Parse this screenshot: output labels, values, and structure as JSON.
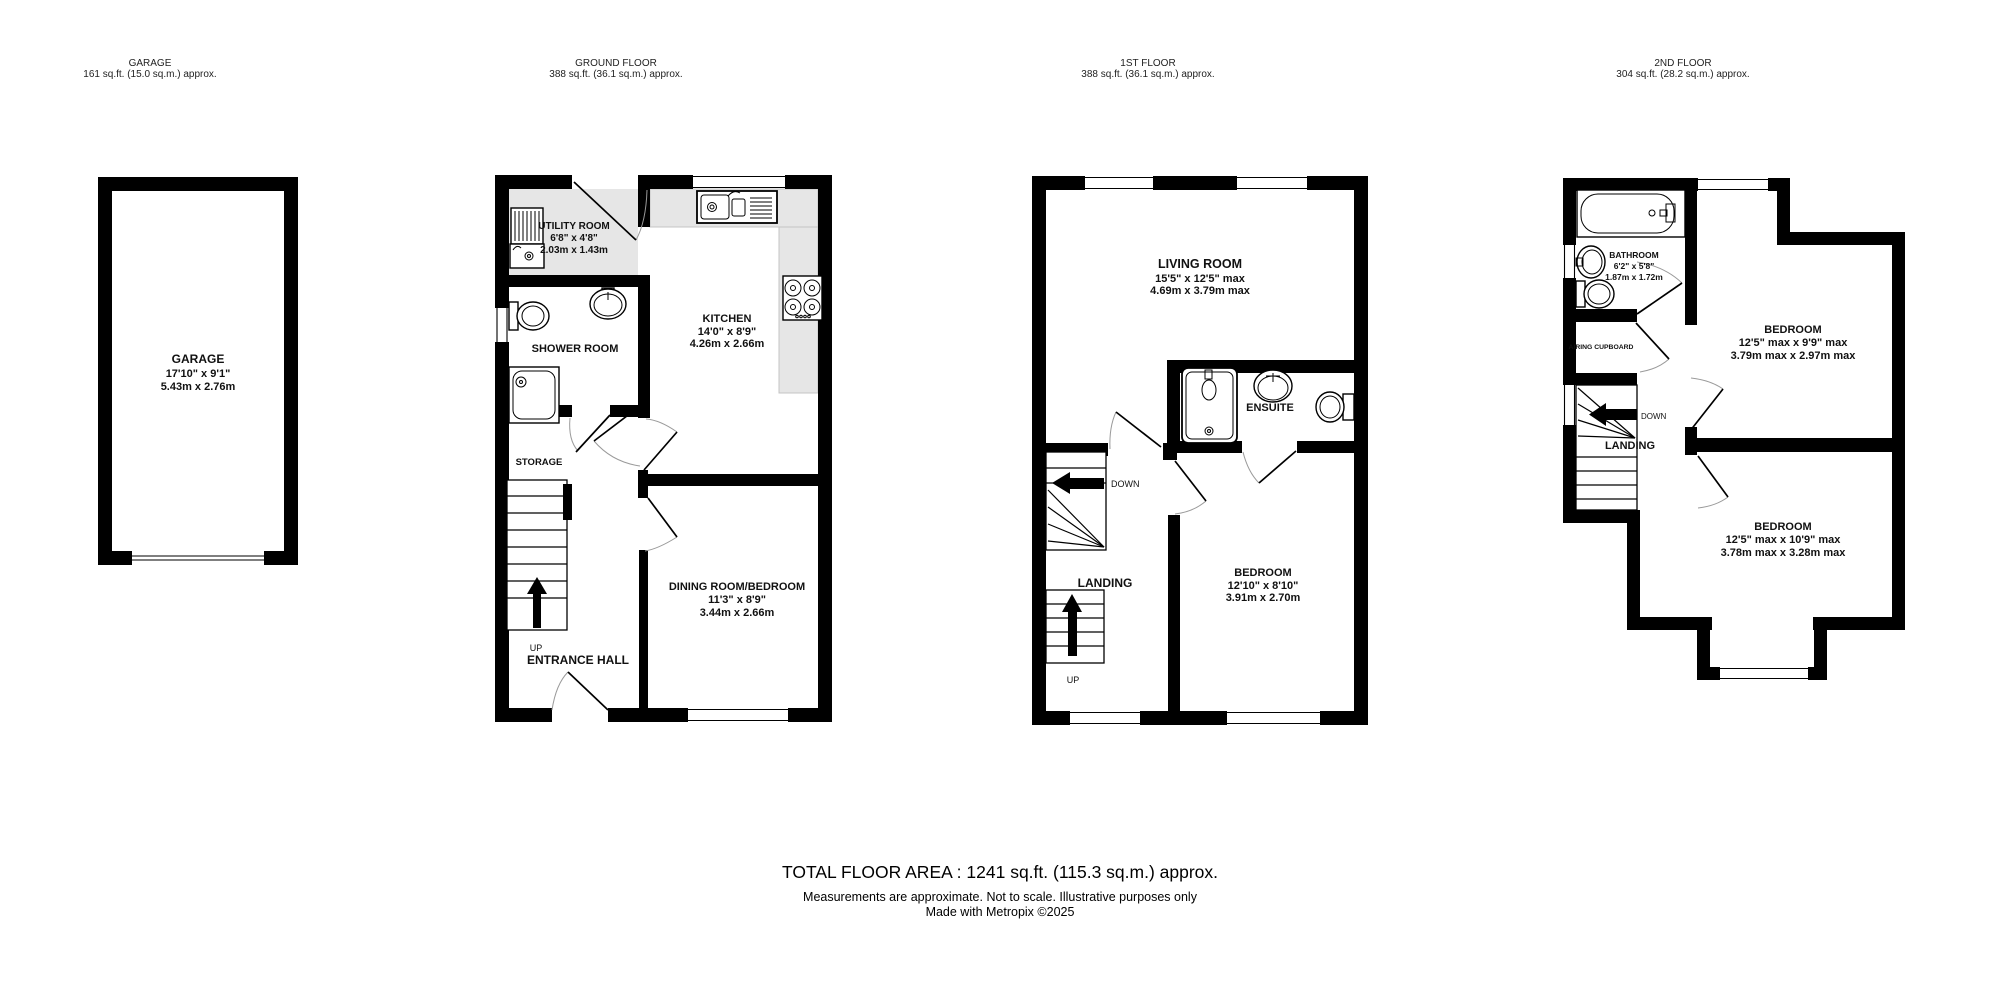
{
  "headers": [
    {
      "title": "GARAGE",
      "area": "161 sq.ft. (15.0 sq.m.) approx."
    },
    {
      "title": "GROUND FLOOR",
      "area": "388 sq.ft. (36.1 sq.m.) approx."
    },
    {
      "title": "1ST FLOOR",
      "area": "388 sq.ft. (36.1 sq.m.) approx."
    },
    {
      "title": "2ND FLOOR",
      "area": "304 sq.ft. (28.2 sq.m.) approx."
    }
  ],
  "rooms": {
    "garage": {
      "name": "GARAGE",
      "imperial": "17'10\"  x 9'1\"",
      "metric": "5.43m  x 2.76m"
    },
    "utility": {
      "name": "UTILITY ROOM",
      "imperial": "6'8\"  x 4'8\"",
      "metric": "2.03m  x 1.43m"
    },
    "kitchen": {
      "name": "KITCHEN",
      "imperial": "14'0\"  x 8'9\"",
      "metric": "4.26m  x 2.66m"
    },
    "shower": {
      "name": "SHOWER ROOM"
    },
    "storage": {
      "name": "STORAGE"
    },
    "entrance": {
      "name": "ENTRANCE HALL"
    },
    "dining": {
      "name": "DINING ROOM/BEDROOM",
      "imperial": "11'3\"  x 8'9\"",
      "metric": "3.44m  x 2.66m"
    },
    "living": {
      "name": "LIVING ROOM",
      "imperial": "15'5\"  x 12'5\" max",
      "metric": "4.69m  x 3.79m max"
    },
    "ensuite": {
      "name": "ENSUITE"
    },
    "landing1": {
      "name": "LANDING"
    },
    "bedroom1": {
      "name": "BEDROOM",
      "imperial": "12'10\"  x 8'10\"",
      "metric": "3.91m  x 2.70m"
    },
    "bathroom": {
      "name": "BATHROOM",
      "imperial": "6'2\"  x 5'8\"",
      "metric": "1.87m  x 1.72m"
    },
    "airing": {
      "name": "AIRING CUPBOARD"
    },
    "landing2": {
      "name": "LANDING"
    },
    "bedroom2": {
      "name": "BEDROOM",
      "imperial": "12'5\" max x 9'9\" max",
      "metric": "3.79m max x 2.97m max"
    },
    "bedroom3": {
      "name": "BEDROOM",
      "imperial": "12'5\" max x 10'9\" max",
      "metric": "3.78m max x 3.28m max"
    }
  },
  "stairs": {
    "up": "UP",
    "down": "DOWN"
  },
  "footer": {
    "total": "TOTAL FLOOR AREA : 1241 sq.ft. (115.3 sq.m.) approx.",
    "disclaimer": "Measurements are approximate.  Not to scale.  Illustrative purposes only",
    "credit": "Made with Metropix ©2025"
  }
}
